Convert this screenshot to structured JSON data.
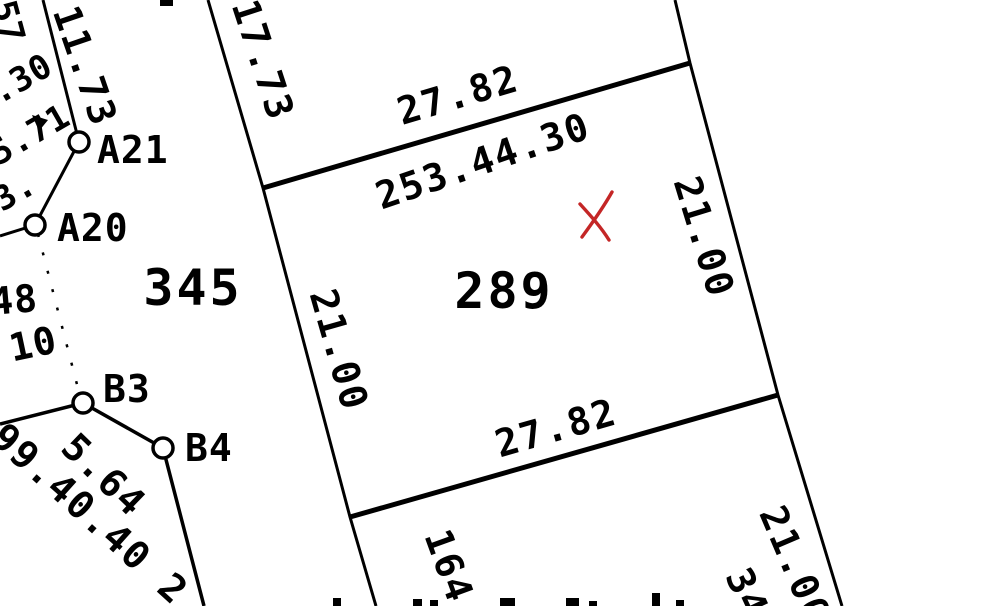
{
  "colors": {
    "ink": "#000000",
    "background": "#ffffff",
    "annotation_red": "#c42626"
  },
  "map": {
    "parcel_numbers": [
      {
        "text": "345"
      },
      {
        "text": "289"
      }
    ],
    "survey_points": [
      {
        "label": "A21"
      },
      {
        "label": "A20"
      },
      {
        "label": "B3"
      },
      {
        "label": "B4"
      }
    ],
    "dimensions": [
      {
        "text": "11.73"
      },
      {
        "text": "17.73"
      },
      {
        "text": "27.82"
      },
      {
        "text": "253.44.30"
      },
      {
        "text": "21.00"
      },
      {
        "text": "21.00"
      },
      {
        "text": "27.82"
      },
      {
        "text": "164"
      },
      {
        "text": "21.00"
      },
      {
        "text": "34"
      },
      {
        "text": "5.64"
      },
      {
        "text": "99.40.40 2"
      }
    ],
    "edge_fragments": [
      {
        "text": "57"
      },
      {
        "text": ".30"
      },
      {
        "text": "5.71"
      },
      {
        "text": "3."
      },
      {
        "text": "48"
      },
      {
        "text": "10"
      }
    ],
    "annotation": {
      "symbol": "X"
    }
  }
}
